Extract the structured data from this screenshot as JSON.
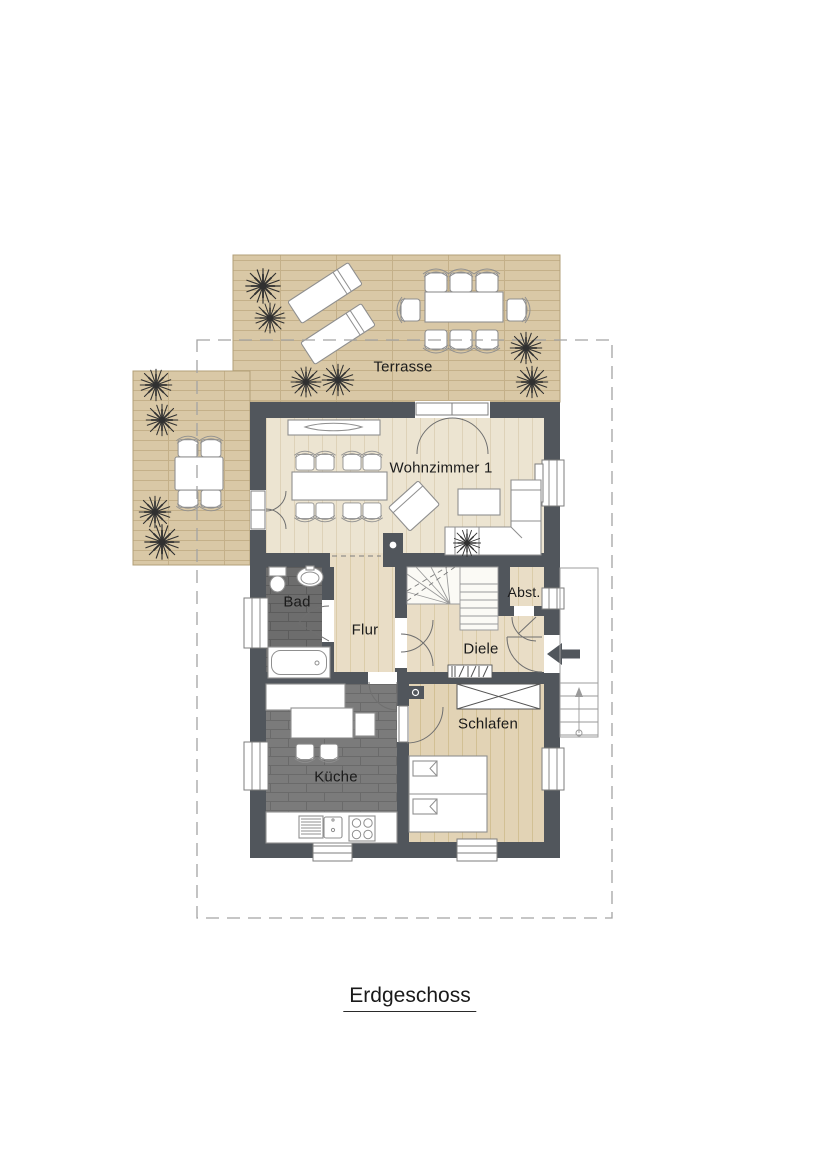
{
  "plan": {
    "title": "Erdgeschoss",
    "labels": {
      "terrasse": "Terrasse",
      "wohnzimmer": "Wohnzimmer 1",
      "bad": "Bad",
      "flur": "Flur",
      "abstellraum": "Abst.",
      "diele": "Diele",
      "schlafen": "Schlafen",
      "kueche": "Küche"
    },
    "colors": {
      "wall": "#51565c",
      "deck": "#d9c8a6",
      "deck_line": "#c4b089",
      "deck_edge": "#b29f78",
      "wood_a": "#ece4d1",
      "wood_a_line": "#ded2b8",
      "wood_b": "#e9ddc6",
      "wood_b_line": "#dbcca9",
      "wood_c": "#e2d3b5",
      "wood_c_line": "#d2c094",
      "tile_dark": "#6d6d6d",
      "tile_dark_line": "#5c5c5c",
      "tile_mid": "#7b7b7b",
      "tile_mid_line": "#6a6a6a",
      "furn": "#8f8f8f",
      "outline": "#555555",
      "boundary": "#a3a3a3",
      "plant": "#303030",
      "text": "#1b1b1b"
    }
  }
}
